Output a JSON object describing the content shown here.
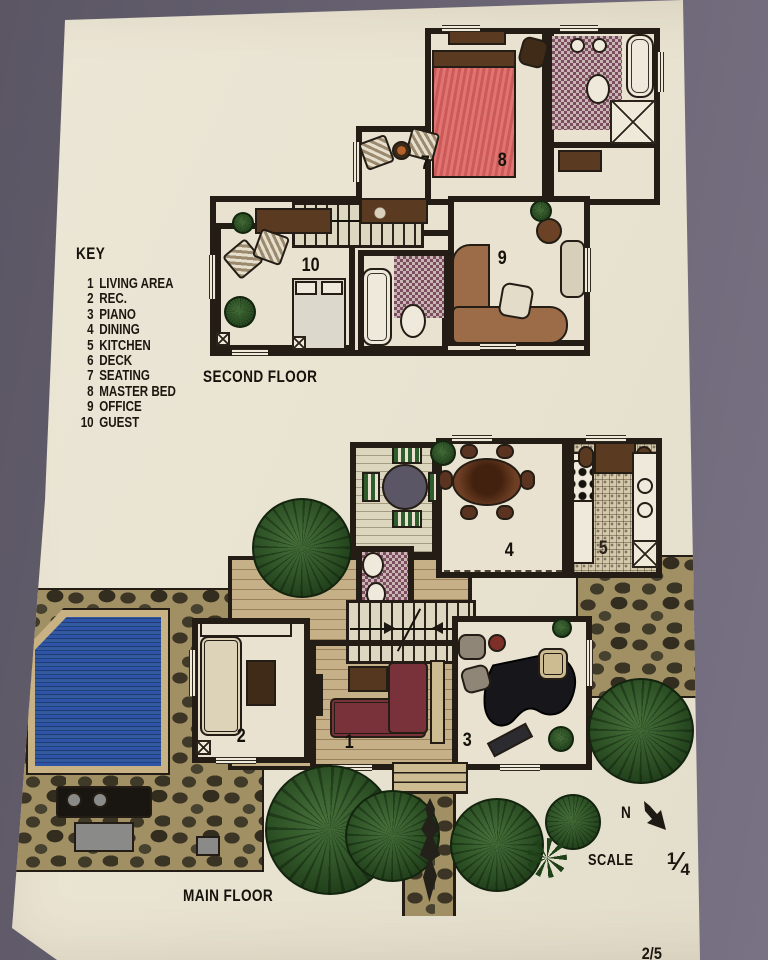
{
  "page": {
    "type": "hand-drawn architectural floor plan photo",
    "page_number": "2/5",
    "colors": {
      "backdrop": "#6a6474",
      "paper": "#e9e3d2",
      "walls": "#241d15",
      "pool_blue": "#2d54a6",
      "tree_green": "#2f5427",
      "bed_pink": "#df7471",
      "sofa_maroon": "#79313a",
      "stone_tan": "#a29065",
      "bath_tile_purple": "#7c4c60"
    }
  },
  "key": {
    "title": "KEY",
    "items": [
      {
        "num": "1",
        "label": "LIVING AREA"
      },
      {
        "num": "2",
        "label": "REC."
      },
      {
        "num": "3",
        "label": "PIANO"
      },
      {
        "num": "4",
        "label": "DINING"
      },
      {
        "num": "5",
        "label": "KITCHEN"
      },
      {
        "num": "6",
        "label": "DECK"
      },
      {
        "num": "7",
        "label": "SEATING"
      },
      {
        "num": "8",
        "label": "MASTER BED"
      },
      {
        "num": "9",
        "label": "OFFICE"
      },
      {
        "num": "10",
        "label": "GUEST"
      }
    ]
  },
  "second_floor": {
    "label": "SECOND FLOOR",
    "rooms": [
      "7",
      "8",
      "9",
      "10"
    ]
  },
  "main_floor": {
    "label": "MAIN FLOOR",
    "rooms": [
      "1",
      "2",
      "3",
      "4",
      "5"
    ]
  },
  "compass": {
    "label": "N"
  },
  "scale": {
    "label": "SCALE",
    "numerator": "1",
    "denominator": "4",
    "equals": "= 1'0"
  }
}
